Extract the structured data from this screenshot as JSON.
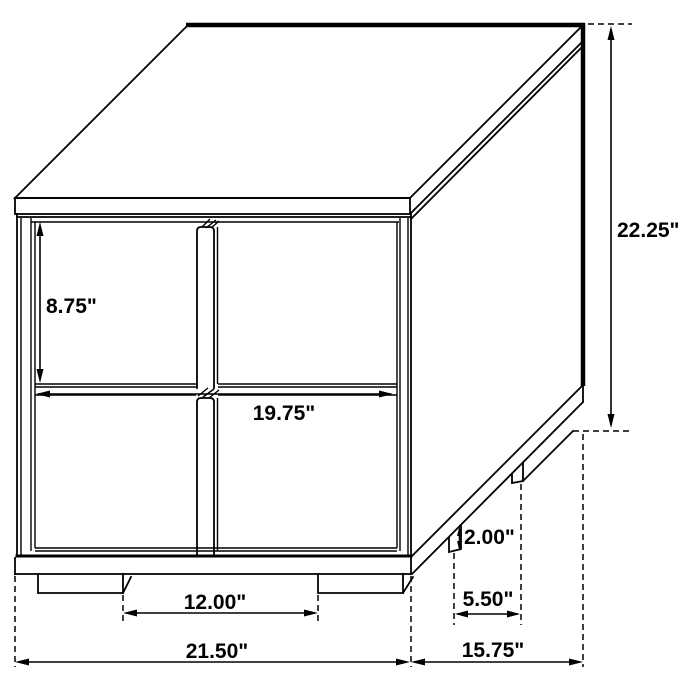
{
  "colors": {
    "line": "#000000",
    "background": "#ffffff"
  },
  "diagram": {
    "dimensions": {
      "drawer_height": "8.75\"",
      "drawer_width": "19.75\"",
      "overall_height": "22.25\"",
      "leg_height": "2.00\"",
      "side_leg_spacing": "5.50\"",
      "front_leg_spacing": "12.00\"",
      "overall_width": "21.50\"",
      "overall_depth": "15.75\""
    }
  }
}
